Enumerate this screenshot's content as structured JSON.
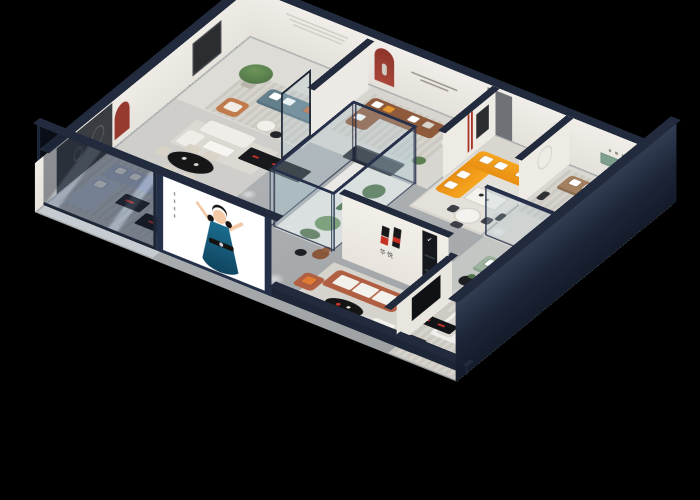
{
  "scene": {
    "title": "3D isometric cutaway render of a furniture showroom",
    "background_color": "#000000",
    "brand": {
      "logo_text": "华悦",
      "display_check": "✓",
      "logo_black": "#17171a",
      "logo_red": "#c53022",
      "logo_wall_color": "#f0ede8"
    },
    "structure": {
      "exterior_wall_color": "#232c3f",
      "wall_cap_color": "#222b3d",
      "interior_wall_color": "#ece9e3",
      "red_niche_color": "#963a2f",
      "green_wall_panel_color": "#7e9e8e",
      "glass_tint": "rgba(172,200,212,0.26)",
      "floor_color": "#b3b6b7"
    },
    "poster": {
      "subject": "illustrated woman in teal dress, arms raised",
      "background": "#ffffff",
      "dress_color": "#176083",
      "hair_color": "#161210",
      "frame_color": "#243048"
    },
    "rooms": [
      {
        "name": "teal-lounge",
        "items": "teal sofa, orange armchair, potted tree, round tables",
        "sofa_color": "#64808d"
      },
      {
        "name": "brown-lounge",
        "items": "brown leather corner sofa, white/orange pillows, red arched niche, wall slogan",
        "sofa_color": "#8f5a3c"
      },
      {
        "name": "orange-lounge",
        "items": "orange L-sectional, marble coffee table, figure sculpture, round dining set",
        "sofa_color": "#f6a51f"
      },
      {
        "name": "tan-lounge",
        "items": "tan three-seat sofa, green wall panel, ring lamp, black round tables",
        "sofa_color": "#a3805f"
      },
      {
        "name": "sage-lounge",
        "items": "sage sofa, glass display case, black side table with plant",
        "sofa_color": "#9db29e"
      },
      {
        "name": "dining-room",
        "items": "black oval table, cream chairs, white sofa set, dark media console, red arched niche",
        "table_color": "#141414"
      },
      {
        "name": "blue-lounge",
        "items": "light blue sectional behind glass facade, dark consoles with red accents",
        "sofa_color": "#b7c3de"
      },
      {
        "name": "brand-lounge",
        "items": "terracotta sofa with white cushions, black oval coffee table, white ottoman, logo wall",
        "sofa_color": "#b05f42"
      },
      {
        "name": "bedroom",
        "items": "white double bed, dark wardrobe, TV partition",
        "bed_color": "#f0efec"
      },
      {
        "name": "atrium",
        "items": "glass enclosure with cacti and plants, plush bear figure, reception desk",
        "plant_color": "#4f7248"
      }
    ]
  }
}
